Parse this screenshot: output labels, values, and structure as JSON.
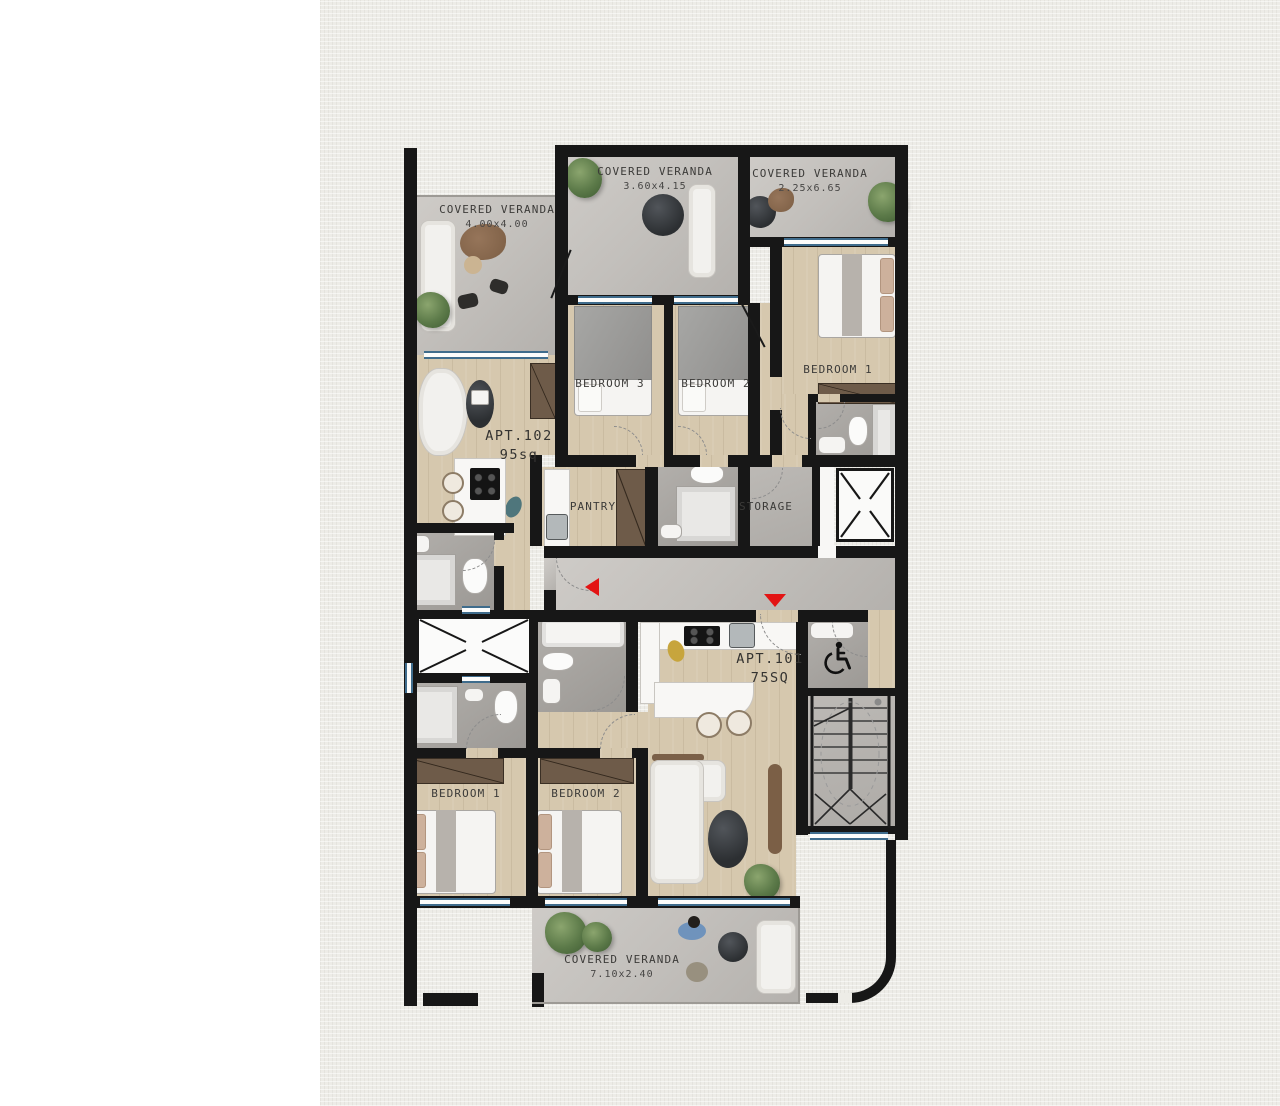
{
  "colors": {
    "wall": "#171717",
    "wood_floor": "#d6c8ae",
    "concrete_floor": "#c2bfbb",
    "bathroom_floor": "#a5a29e",
    "window_blue": "#3f6c8c",
    "entrance_arrow_red": "#e31414",
    "closet_brown": "#6e5b49",
    "paper_background": "#edece7"
  },
  "verandas": [
    {
      "name": "COVERED VERANDA",
      "dims": "4.00x4.00"
    },
    {
      "name": "COVERED VERANDA",
      "dims": "3.60x4.15"
    },
    {
      "name": "COVERED VERANDA",
      "dims": "2.25x6.65"
    },
    {
      "name": "COVERED VERANDA",
      "dims": "7.10x2.40"
    }
  ],
  "apt102": {
    "name": "APT.102",
    "area": "95sq",
    "bedrooms": [
      "BEDROOM 3",
      "BEDROOM 2",
      "BEDROOM 1"
    ],
    "rooms": {
      "pantry": "PANTRY",
      "storage": "STORAGE"
    }
  },
  "apt101": {
    "name": "APT.101",
    "area": "75SQ",
    "bedrooms": [
      "BEDROOM 1",
      "BEDROOM 2"
    ]
  }
}
